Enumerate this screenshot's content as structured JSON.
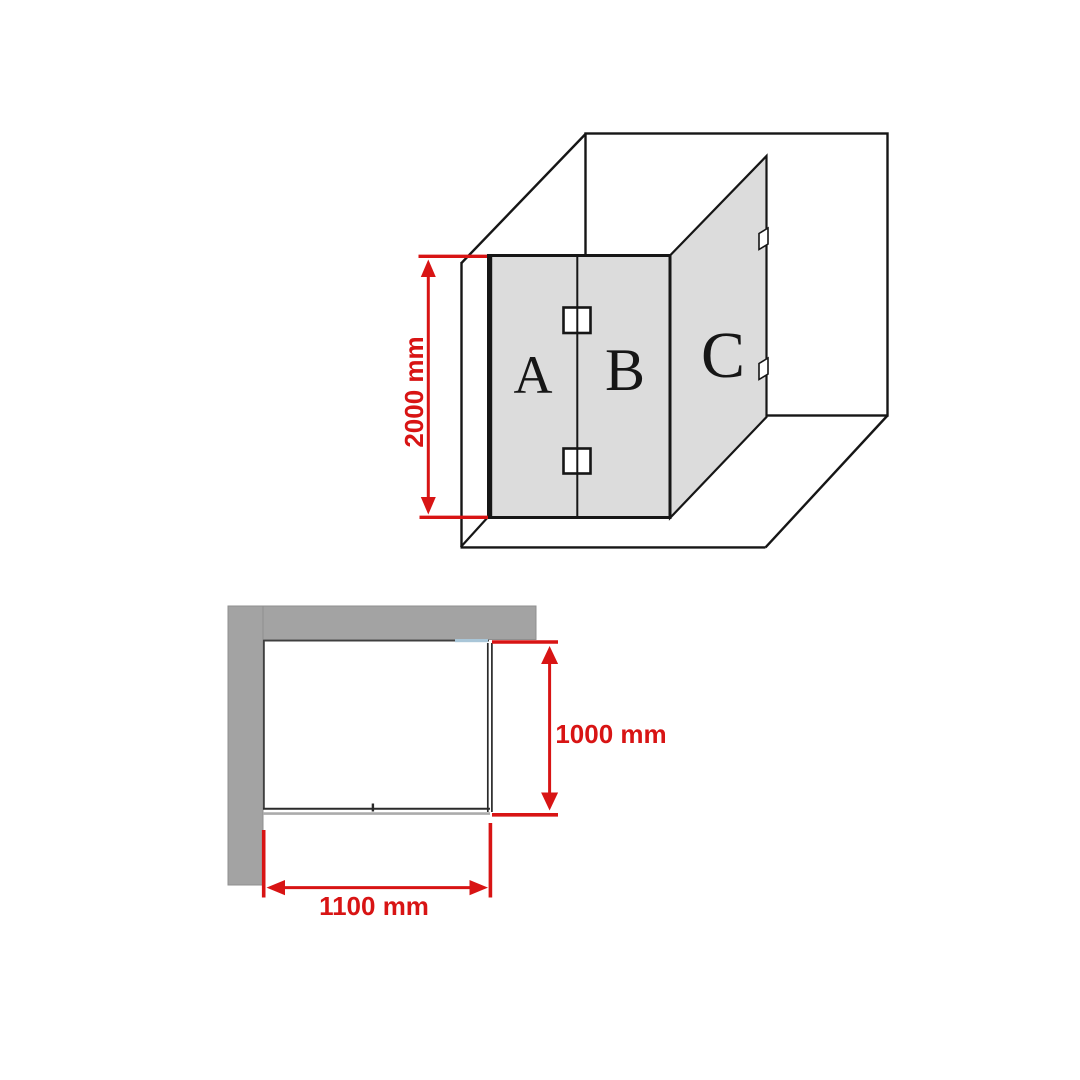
{
  "title": "shower-screen-dimension-diagram",
  "colors": {
    "accent_red": "#d81414",
    "line_black": "#161616",
    "panel_gray": "#dcdcdc",
    "wall_gray": "#a3a3a3",
    "wall_outline": "#8f8f8f",
    "inner_line": "#3f3f3f",
    "glass_dark": "#2a2a2a",
    "glass_line_gray": "#ababab",
    "glass_blue": "#a9c6d8"
  },
  "elevation_view": {
    "panels": [
      {
        "label": "A"
      },
      {
        "label": "B"
      },
      {
        "label": "C"
      }
    ],
    "height_dimension": {
      "label": "2000 mm"
    }
  },
  "plan_view": {
    "depth_dimension": {
      "label": "1000 mm"
    },
    "width_dimension": {
      "label": "1100 mm"
    }
  }
}
